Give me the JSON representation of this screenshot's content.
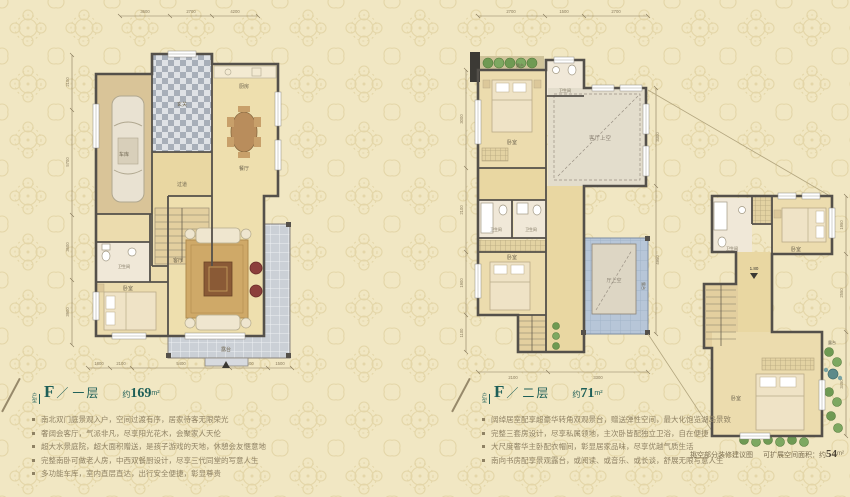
{
  "page": {
    "bg": "#f1e7c3"
  },
  "captions": {
    "attic_note": "挑空部分装修建议图",
    "expand_prefix": "可扩展空间面积：约",
    "expand_value": "54",
    "expand_unit": "m²"
  },
  "plans": [
    {
      "tag": "户型",
      "letter": "F",
      "divider": "／",
      "floor": "一层",
      "area_prefix": "约",
      "area_value": "169",
      "area_unit": "m²",
      "bullets": [
        "南北双门庭景观入户，空间过渡有序，居家待客无限荣光",
        "奢阔会客厅，气派非凡，尽享阳光花木，会聚家人天伦",
        "超大水景庭院，超大面积赠送，是孩子游戏的天地，休憩会友惬意地",
        "完整南卧可做老人房，中西双餐厨设计，尽享三代同堂的写意人生",
        "多功能车库，室内直层直达，出行安全便捷，彰显尊贵"
      ],
      "rooms": {
        "garage": "车库",
        "foyer": "玄关",
        "kitchen": "厨房",
        "dining": "餐厅",
        "hall": "过道",
        "living": "客厅",
        "bedroom": "卧室",
        "bath": "卫生间",
        "porch": "露台"
      },
      "dims_top": [
        "3600",
        "2700",
        "4200"
      ],
      "dims_left": [
        "2100",
        "5700",
        "3600",
        "3900"
      ],
      "dims_bottom": [
        "1800",
        "2100",
        "5400",
        "3600",
        "1500"
      ]
    },
    {
      "tag": "户型",
      "letter": "F",
      "divider": "／",
      "floor": "二层",
      "area_prefix": "约",
      "area_value": "71",
      "area_unit": "m²",
      "bullets": [
        "阔绰居室配享超豪华转角双观景台，赠送弹性空间，最大化饱览湖岛景致",
        "完整三套房设计，尽享私属领地，主次卧皆配独立卫浴，自在便捷",
        "大尺度奢华主卧配衣帽间，彰显居家品味，尽享优越气质生活",
        "南向书房配享景观露台，或阅读、或音乐、或长谈，舒展无限写意人生"
      ],
      "rooms": {
        "terrace_top": "露台",
        "bedroom_main": "卧室",
        "bath_top": "卫生间",
        "void_living": "客厅上空",
        "bath_left": "卫生间",
        "bath_right": "卫生间",
        "bedroom_south": "卧室",
        "void_hall": "厅上空",
        "roof_terrace": "露台"
      },
      "dims_top": [
        "2700",
        "1500",
        "2700"
      ],
      "dims_left": [
        "3000",
        "2100",
        "1900",
        "1100"
      ],
      "dims_right": [
        "3300",
        "4950"
      ],
      "dims_bottom": [
        "2100",
        "3300"
      ]
    },
    {
      "rooms": {
        "bath": "卫生间",
        "bedroom_top": "卧室",
        "height_mark": "1.80",
        "bedroom_low": "卧室",
        "terrace": "露台"
      },
      "dims_right": [
        "1950",
        "2550",
        "3450"
      ]
    }
  ]
}
